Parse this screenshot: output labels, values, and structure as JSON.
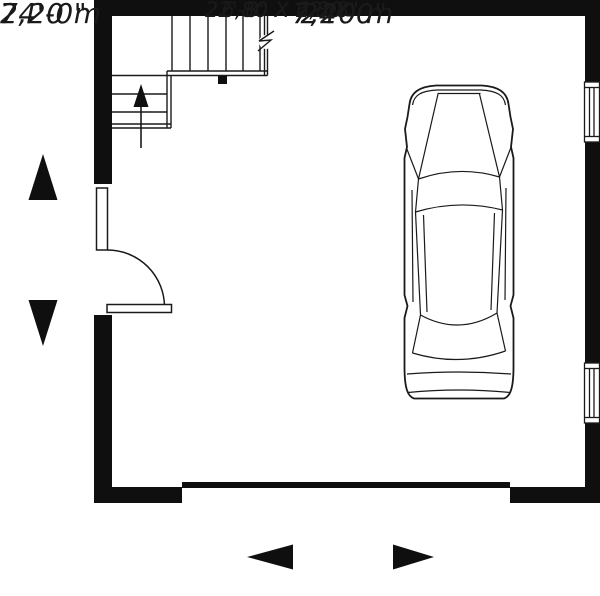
{
  "floor_plan": {
    "room_label": {
      "imperial": "22'-8\" X 22'-8\"",
      "metric": "6,80 X 6,80"
    },
    "dimension_left": {
      "imperial": "24'-0\"",
      "metric": "7,20 m"
    },
    "dimension_bottom": {
      "imperial": "24'-0\"",
      "metric": "7,20 m"
    },
    "colors": {
      "wall": "#0f0f0f",
      "line": "#1a1a1a",
      "background": "#ffffff"
    },
    "icons": {
      "car": "car-top-view-icon",
      "stairs": "staircase-icon",
      "stairs_direction": "stairs-up-arrow-icon",
      "entry_door": "door-swing-icon",
      "windows": "window-symbol-icon",
      "garage_door": "garage-door-band",
      "dimension_arrows": [
        "arrow-up-icon",
        "arrow-down-icon",
        "arrow-left-icon",
        "arrow-right-icon"
      ]
    }
  }
}
